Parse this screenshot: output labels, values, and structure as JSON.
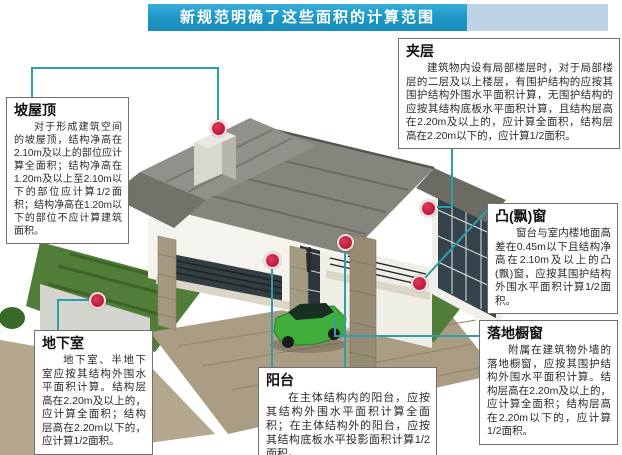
{
  "banner": {
    "title": "新规范明确了这些面积的计算范围"
  },
  "callouts": [
    {
      "title": "坡屋顶",
      "body": "对于形成建筑空间的坡屋顶，结构净高在2.10m及以上的部位应计算全面积；结构净高在1.20m及以上至2.10m以下的部位应计算1/2面积；结构净高在1.20m以下的部位不应计算建筑面积。"
    },
    {
      "title": "夹层",
      "body": "建筑物内设有局部楼层时，对于局部楼层的二层及以上楼层，有围护结构的应按其围护结构外围水平面积计算，无围护结构的应按其结构底板水平面积计算，且结构层高在2.20m及以上的，应计算全面积，结构层高在2.20m以下的，应计算1/2面积。"
    },
    {
      "title": "凸(飘)窗",
      "body": "窗台与室内楼地面高差在0.45m以下且结构净高在2.10m及以上的凸(飘)窗，应按其围护结构外围水平面积计算1/2面积。"
    },
    {
      "title": "落地橱窗",
      "body": "附属在建筑物外墙的落地橱窗，应按其围护结构外围水平面积计算。结构层高在2.20m及以上的，应计算全面积；结构层高在2.20m以下的，应计算1/2面积。"
    },
    {
      "title": "地下室",
      "body": "地下室、半地下室应按其结构外围水平面积计算。结构层高在2.20m及以上的，应计算全面积；结构层高在2.20m以下的，应计算1/2面积。"
    },
    {
      "title": "阳台",
      "body": "在主体结构内的阳台，应按其结构外围水平面积计算全面积；在主体结构外的阳台，应按其结构底板水平投影面积计算1/2面积。"
    }
  ],
  "colors": {
    "banner_blue": "#1f9cc9",
    "banner_light": "#bfd3e6",
    "leader_line": "#2f9daa",
    "marker_red": "#c22040",
    "box_border": "#6f6f6f"
  }
}
